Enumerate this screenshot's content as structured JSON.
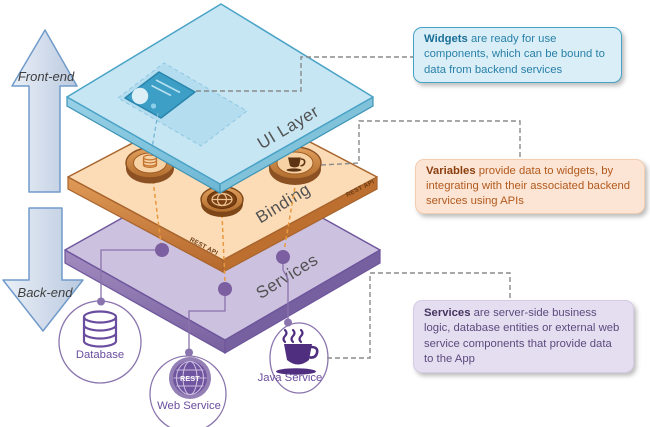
{
  "arrows": {
    "up": "Front-end",
    "down": "Back-end"
  },
  "layers": {
    "ui": "UI Layer",
    "binding": "Binding",
    "services": "Services",
    "rest_api_right": "REST API",
    "rest_api_left": "REST API"
  },
  "services": {
    "database": "Database",
    "web": "Web Service",
    "java": "Java Service",
    "web_globe": "REST"
  },
  "annotations": {
    "widgets": {
      "lead": "Widgets",
      "body": "are ready for use components, which can be bound to data from backend services"
    },
    "variables": {
      "lead": "Variables",
      "body": "provide data to widgets, by integrating with their associated backend services using APIs"
    },
    "services": {
      "lead": "Services",
      "body": "are server-side business logic, database entities or external web service components that provide data to the App"
    }
  },
  "colors": {
    "ui_face": "#c6e6f4",
    "ui_border": "#4aa3c6",
    "binding_face": "#fcdcb6",
    "binding_border": "#a8642d",
    "services_face": "#cdc1e0",
    "services_border": "#6e569c",
    "purple_icon": "#6a4d9e",
    "purple_dark": "#4f2d7f",
    "coin_rim": "#8c5123",
    "coin_face": "#f7d2a4",
    "connector_dash": "#8a8a8a",
    "callout_blue": "#d9eef7",
    "callout_orange": "#fce5d4",
    "callout_purple": "#e4def0"
  }
}
